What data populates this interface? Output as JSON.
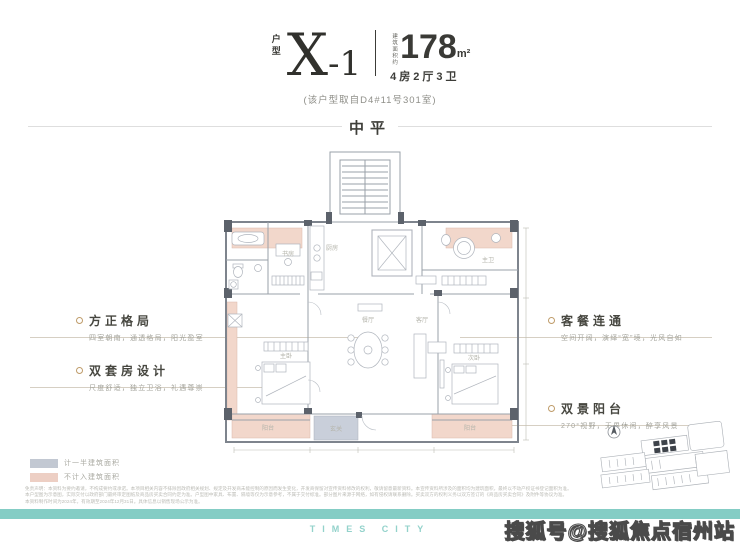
{
  "header": {
    "unit_label": "户型",
    "code_main": "X",
    "code_sub": "-1",
    "area_prefix": "建筑面积约",
    "area_value": "178",
    "area_unit": "m²",
    "layout": "4房2厅3卫",
    "source_note": "(该户型取自D4#11号301室)"
  },
  "section": {
    "floor_label": "中平"
  },
  "callouts": {
    "left": [
      {
        "title": "方正格局",
        "desc": "四室朝南，通透格局，阳光盈室"
      },
      {
        "title": "双套房设计",
        "desc": "尺度舒适，独立卫浴，礼遇尊崇"
      }
    ],
    "right": [
      {
        "title": "客餐连通",
        "desc": "空间开阔，演绎“宽”境，光风自如"
      },
      {
        "title": "双景阳台",
        "desc": "270°视野，无界休闲，醉享风景"
      }
    ]
  },
  "legend": [
    {
      "label": "计一半建筑面积",
      "color": "#c2c8d2"
    },
    {
      "label": "不计入建筑面积",
      "color": "#edcfc4"
    }
  ],
  "floor_plan": {
    "rooms": [
      {
        "name": "书房"
      },
      {
        "name": "厨房"
      },
      {
        "name": "主卫"
      },
      {
        "name": "餐厅"
      },
      {
        "name": "客厅"
      },
      {
        "name": "主卧"
      },
      {
        "name": "次卧"
      },
      {
        "name": "阳台"
      },
      {
        "name": "阳台"
      },
      {
        "name": "玄关"
      }
    ]
  },
  "footer": {
    "brand_text": "TIMES CITY",
    "watermark": "搜狐号@搜狐焦点宿州站",
    "disclaimer_line1": "免责声明：本资料为要约邀请，不构成要约或承诺。本项目相关内容不排除因政府相关规划、规定及开发商未能控制的原因而发生变化，开发商保留对宣传资料修改的权利，敬请留意最新资料。本宣传资料所涉及的面积均为建筑面积，最终以不动产权证书登记面积为准。",
    "disclaimer_line2": "本户型图为示意图，实际交付以政府部门最终审定图纸及商品房买卖合同约定为准。户型图中家具、布置、隔墙等仅为示意参考，不属于交付标准。部分图片来源于网络，如有侵权请联系删除。买卖双方的权利义务以双方签订的《商品房买卖合同》及附件等协议为准。",
    "disclaimer_line3": "本资料制作时间为2024年，有效期至2024年12月31日。具体信息以销售现场公示为准。"
  },
  "colors": {
    "accent_teal": "#84cdc5",
    "balcony_pink": "#f2d7cb",
    "half_area_gray": "#c9cfda",
    "title_dark": "#3c3c38",
    "bullet_gold": "#bf9c6a"
  }
}
